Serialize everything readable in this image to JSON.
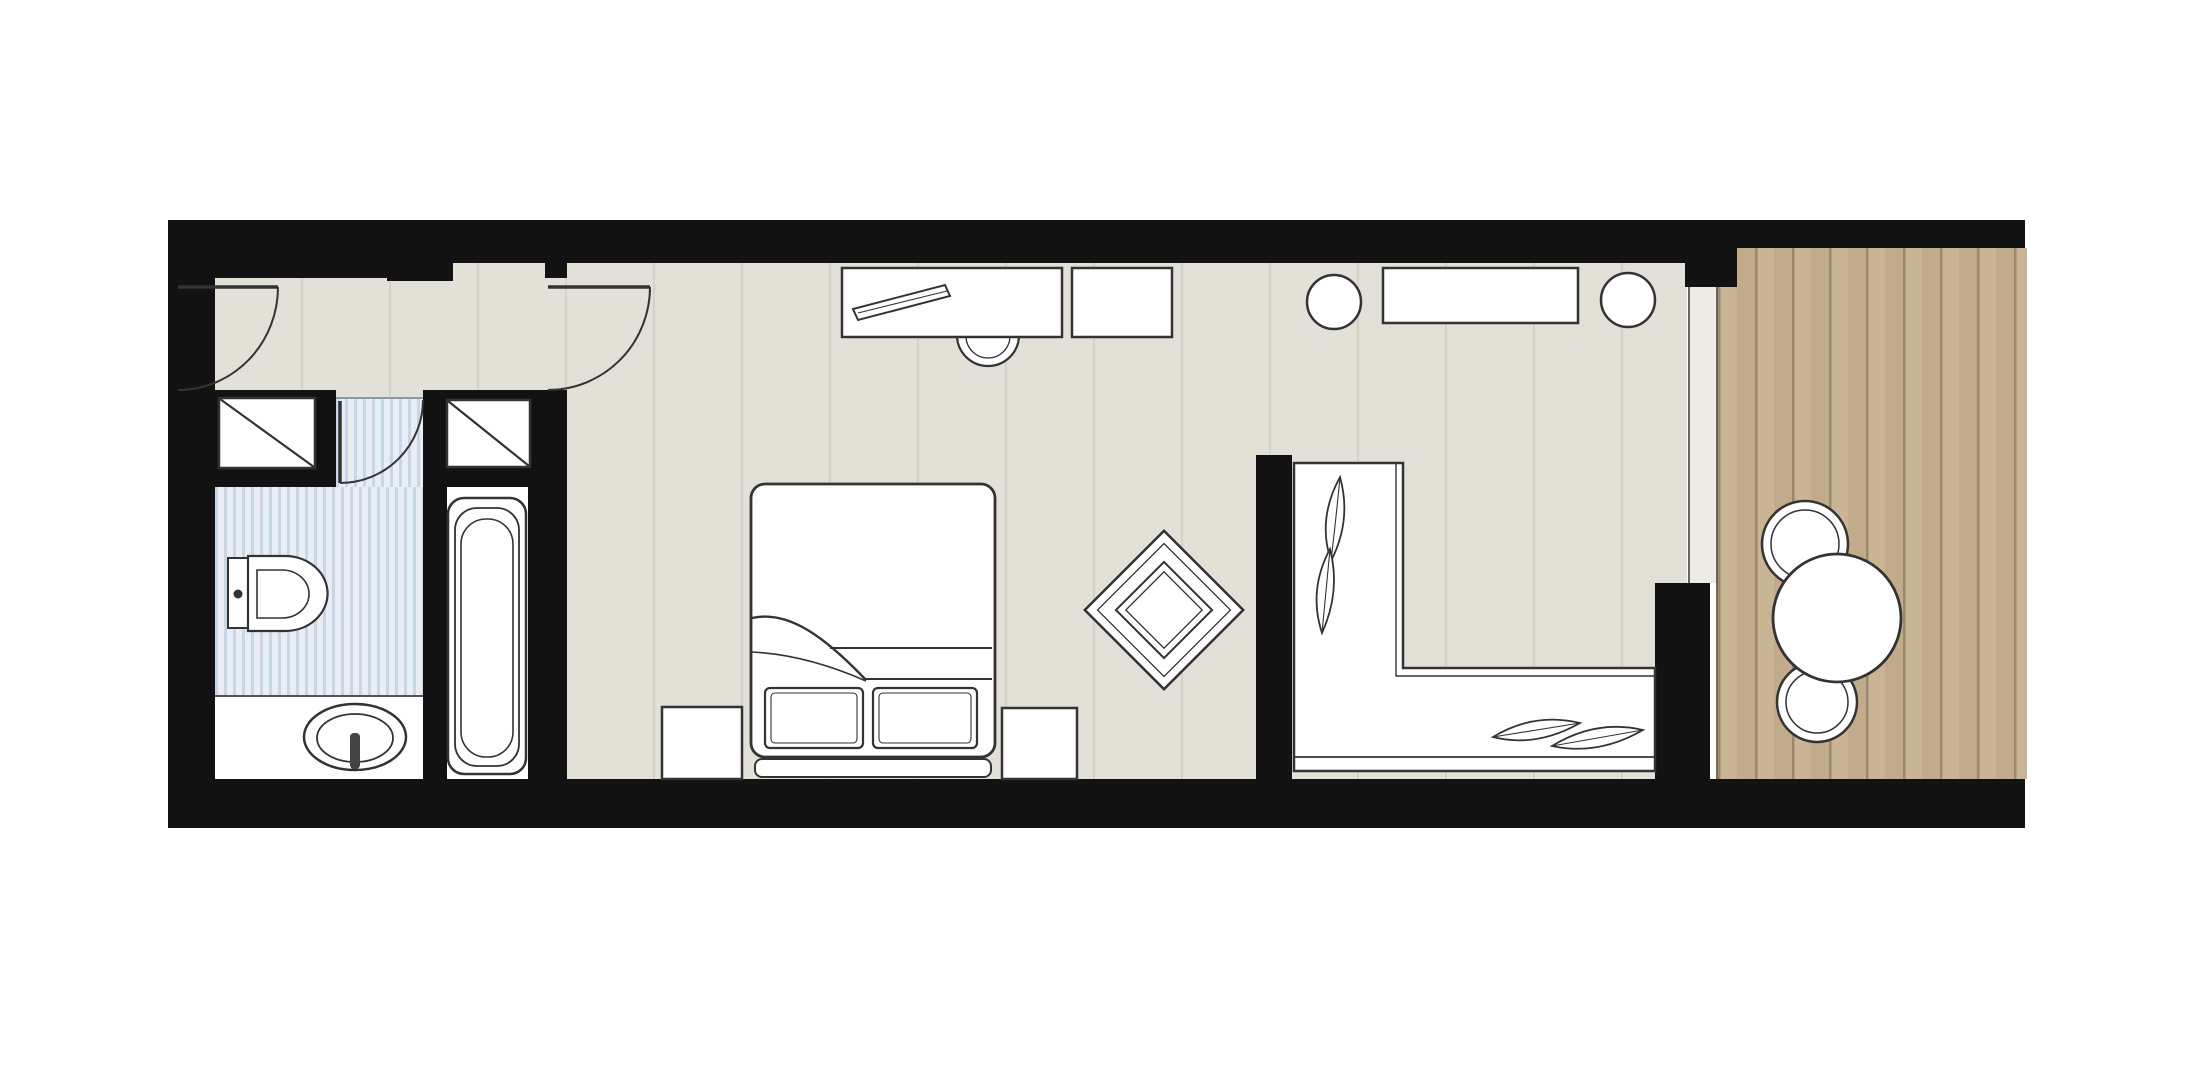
{
  "meta": {
    "description": "hotel suite floor plan, top-down architectural drawing, no text labels"
  },
  "colors": {
    "page_bg": "#ffffff",
    "wall": "#121212",
    "floor": "#e2e0d7",
    "floor_seam": "#cfcdc0",
    "bath_stripe_light": "#e8eef4",
    "bath_stripe_dark": "#c6d7e5",
    "deck_plank": "#c9b494",
    "deck_seam": "#9a8a6d",
    "furniture_fill": "#ffffff",
    "line": "#333333",
    "slide_strip": "#edece4"
  },
  "rooms": [
    {
      "name": "entry-hallway",
      "floor": "grey-panels"
    },
    {
      "name": "bathroom",
      "floor": "blue-stripes"
    },
    {
      "name": "bathtub-compartment",
      "floor": "white"
    },
    {
      "name": "bedroom-living",
      "floor": "grey-panels"
    },
    {
      "name": "sitting-corner",
      "floor": "grey-panels"
    },
    {
      "name": "balcony",
      "floor": "wood-deck"
    }
  ],
  "furniture": [
    "entry-door-swing",
    "bedroom-door-swing",
    "bathroom-door-swing",
    "wardrobe-left",
    "wardrobe-right",
    "toilet",
    "washbasin",
    "bathtub",
    "double-bed",
    "pillow-left",
    "pillow-right",
    "nightstand-left",
    "nightstand-right",
    "desk",
    "tv-on-desk",
    "desk-chair",
    "side-table",
    "console-table",
    "round-stool-left",
    "round-stool-right",
    "armchair-rotated",
    "corner-sofa",
    "sofa-leaf-cushions",
    "sliding-balcony-door",
    "balcony-table",
    "balcony-chair-top",
    "balcony-chair-bottom"
  ]
}
